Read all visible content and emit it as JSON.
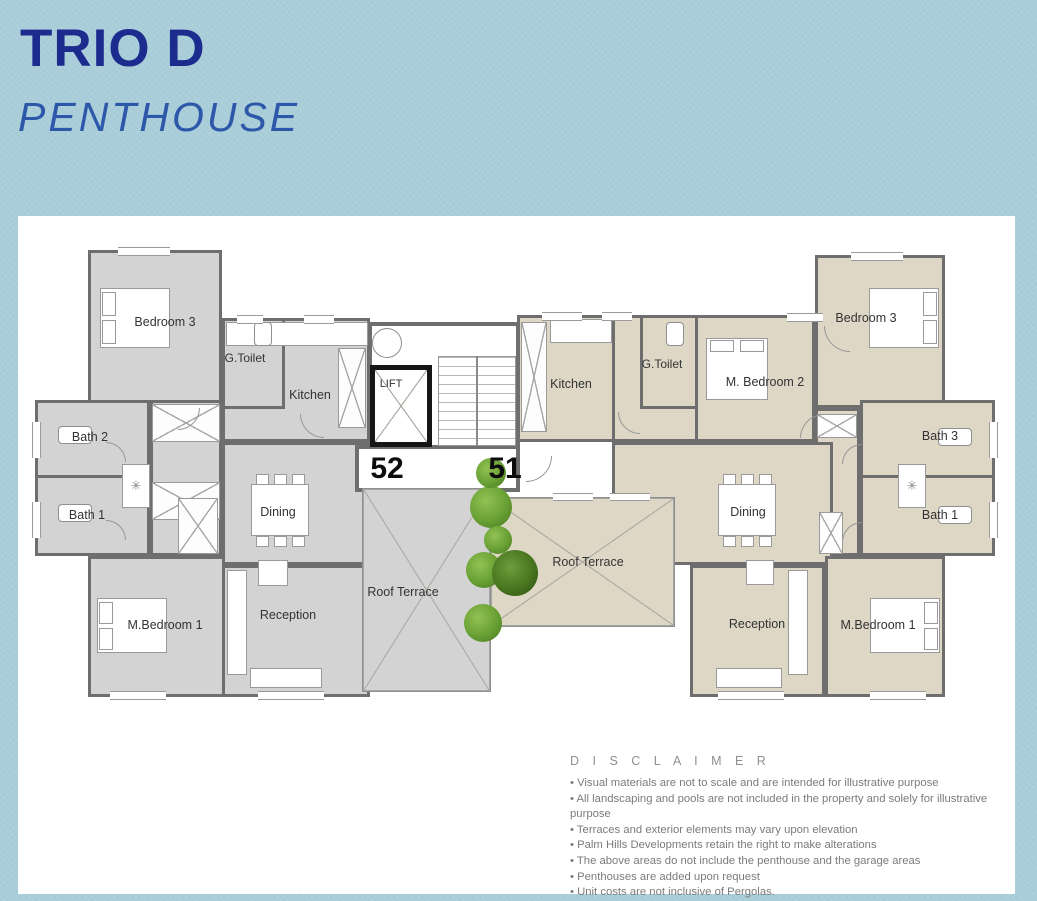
{
  "header": {
    "title": "TRIO D",
    "subtitle": "PENTHOUSE"
  },
  "plan": {
    "lift": "LIFT",
    "left": {
      "number": "52",
      "bedroom3": "Bedroom 3",
      "gtoilet": "G.Toilet",
      "kitchen": "Kitchen",
      "bath2": "Bath 2",
      "bath1": "Bath 1",
      "dining": "Dining",
      "reception": "Reception",
      "mbedroom1": "M.Bedroom 1",
      "roof_terrace": "Roof Terrace"
    },
    "right": {
      "number": "51",
      "kitchen": "Kitchen",
      "gtoilet": "G.Toilet",
      "mbedroom2": "M. Bedroom 2",
      "bedroom3": "Bedroom 3",
      "bath3": "Bath 3",
      "bath1": "Bath 1",
      "dining": "Dining",
      "roof_terrace": "Roof Terrace",
      "reception": "Reception",
      "mbedroom1": "M.Bedroom 1"
    }
  },
  "disclaimer": {
    "title": "D I S C L A I M E R",
    "bullets": [
      "Visual materials are not to scale and are intended for illustrative purpose",
      "All landscaping and pools are not included in the property and solely for illustrative purpose",
      "Terraces and exterior elements may vary upon elevation",
      "Palm Hills Developments retain the right to make alterations",
      "The above areas do not include the penthouse and the garage areas",
      "Penthouses are added upon request",
      "Unit costs are not inclusive of Pergolas."
    ]
  },
  "colors": {
    "background": "#a9cdd9",
    "title": "#1c2b8e",
    "subtitle": "#2d58a9",
    "left_unit_floor": "#d3d3d3",
    "right_unit_floor": "#ded7c6",
    "wall": "#6e6e6e",
    "plant_green": "#68a034"
  }
}
